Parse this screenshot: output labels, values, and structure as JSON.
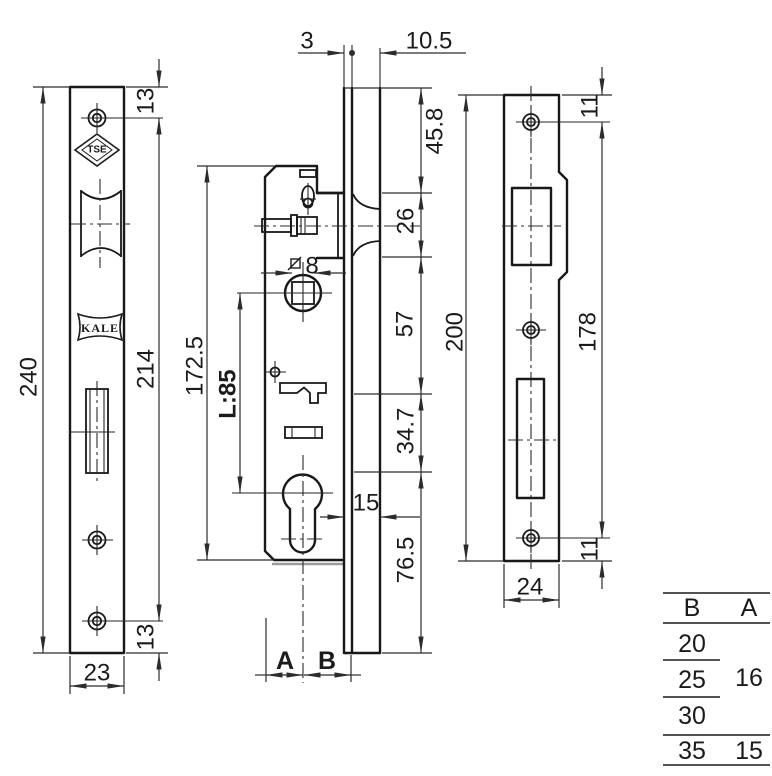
{
  "drawing": {
    "faceplate_view": {
      "overall_height": "240",
      "screw_span": "214",
      "screw_offset_top": "13",
      "screw_offset_bottom": "13",
      "width": "23",
      "tse_logo": "TSE",
      "kale_logo": "KALE"
    },
    "body_view": {
      "faceplate_thickness": "3",
      "profile_depth": "10.5",
      "top_to_latch": "45.8",
      "latch_height": "26",
      "latch_section": "57",
      "mid_section": "34.7",
      "bottom_section": "76.5",
      "case_height": "172.5",
      "center_distance": "L:85",
      "spindle_square": "8",
      "cylinder_to_face": "15",
      "backset_label_a": "A",
      "backset_label_b": "B"
    },
    "strike_view": {
      "overall_height": "200",
      "screw_span": "178",
      "screw_offset_top": "11",
      "screw_offset_bottom": "11",
      "width": "24"
    },
    "size_table": {
      "header_b": "B",
      "header_a": "A",
      "b_values": [
        "20",
        "25",
        "30",
        "35"
      ],
      "a_for_20_25_30": "16",
      "a_for_35": "15"
    }
  }
}
